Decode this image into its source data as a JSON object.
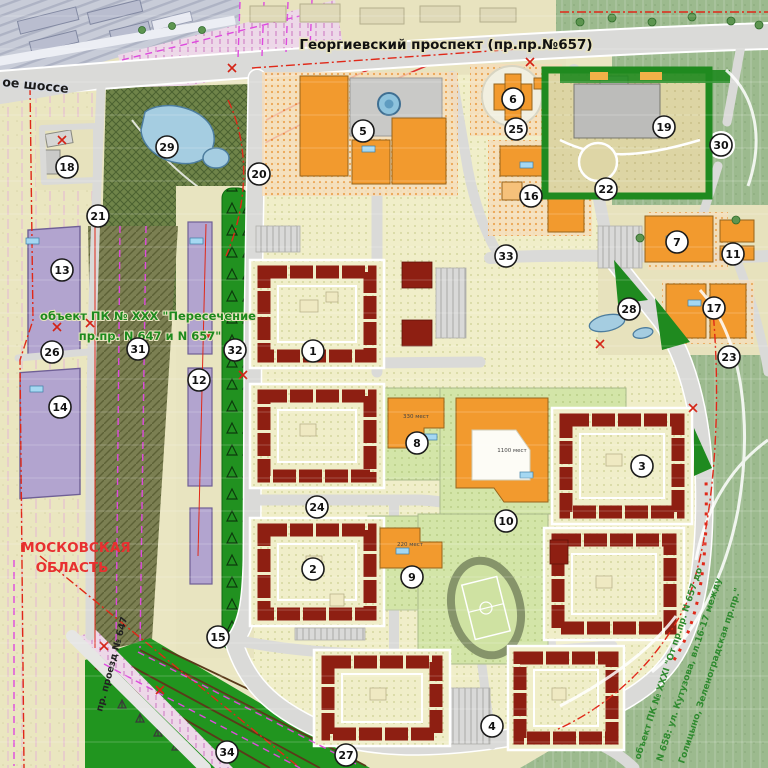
{
  "title": "Георгиевский проспект (пр.пр.№657)",
  "labels": {
    "shosse": "ое шоссе",
    "oblast1": "МОСКОВСКАЯ",
    "oblast2": "ОБЛАСТЬ",
    "pk30_1": "объект ПК № XXX \"Пересечение",
    "pk30_2": "пр.пр. N 647 и N 657\"",
    "proezd": "пр. проезд № 647",
    "pk31_1": "объект ПК № XXXI \"От пр.пр. N 657 до",
    "pk31_2": "N 658: ул. Кутузова, вл.16-17 между",
    "pk31_3": "Голицыно, Зеленоградская пр.пр.\"",
    "cap_school10": "1100 мест",
    "cap_school8": "330 мест",
    "cap_kg9": "220 мест"
  },
  "markers": [
    {
      "n": 1,
      "x": 313,
      "y": 351
    },
    {
      "n": 2,
      "x": 313,
      "y": 569
    },
    {
      "n": 3,
      "x": 642,
      "y": 466
    },
    {
      "n": 4,
      "x": 492,
      "y": 726
    },
    {
      "n": 5,
      "x": 363,
      "y": 131
    },
    {
      "n": 6,
      "x": 513,
      "y": 99
    },
    {
      "n": 7,
      "x": 677,
      "y": 242
    },
    {
      "n": 8,
      "x": 417,
      "y": 443
    },
    {
      "n": 9,
      "x": 412,
      "y": 577
    },
    {
      "n": 10,
      "x": 506,
      "y": 521
    },
    {
      "n": 11,
      "x": 733,
      "y": 254
    },
    {
      "n": 12,
      "x": 199,
      "y": 380
    },
    {
      "n": 13,
      "x": 62,
      "y": 270
    },
    {
      "n": 14,
      "x": 60,
      "y": 407
    },
    {
      "n": 15,
      "x": 218,
      "y": 637
    },
    {
      "n": 16,
      "x": 531,
      "y": 196
    },
    {
      "n": 17,
      "x": 714,
      "y": 308
    },
    {
      "n": 18,
      "x": 67,
      "y": 167
    },
    {
      "n": 19,
      "x": 664,
      "y": 127
    },
    {
      "n": 20,
      "x": 259,
      "y": 174
    },
    {
      "n": 21,
      "x": 98,
      "y": 216
    },
    {
      "n": 22,
      "x": 606,
      "y": 189
    },
    {
      "n": 23,
      "x": 729,
      "y": 357
    },
    {
      "n": 24,
      "x": 317,
      "y": 507
    },
    {
      "n": 25,
      "x": 516,
      "y": 129
    },
    {
      "n": 26,
      "x": 52,
      "y": 352
    },
    {
      "n": 27,
      "x": 346,
      "y": 755
    },
    {
      "n": 28,
      "x": 629,
      "y": 309
    },
    {
      "n": 29,
      "x": 167,
      "y": 147
    },
    {
      "n": 30,
      "x": 721,
      "y": 145
    },
    {
      "n": 31,
      "x": 138,
      "y": 349
    },
    {
      "n": 32,
      "x": 235,
      "y": 350
    },
    {
      "n": 33,
      "x": 506,
      "y": 256
    },
    {
      "n": 34,
      "x": 227,
      "y": 752
    }
  ],
  "colors": {
    "residential_red": "#8e1f12",
    "public_orange": "#f29a2e",
    "industrial_purple": "#b2a4cf",
    "park_green": "#9cba8e",
    "boulevard_green": "#219120",
    "water_blue": "#9fcbe0",
    "road_gray": "#dadad8",
    "boundary_red": "#e02818",
    "plan_magenta": "#de4ade"
  }
}
